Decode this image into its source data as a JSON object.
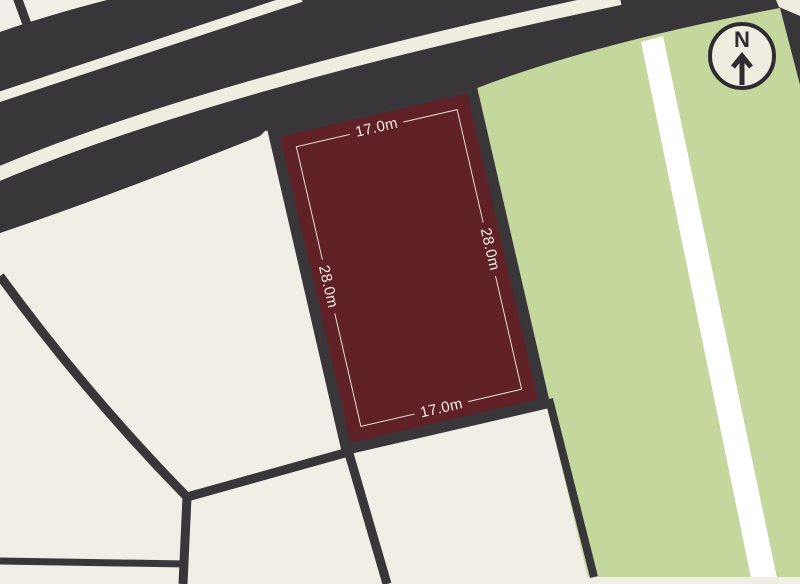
{
  "map": {
    "lot": {
      "dim_top": "17.0m",
      "dim_bottom": "17.0m",
      "dim_left": "28.0m",
      "dim_right": "28.0m"
    },
    "compass": {
      "label": "N",
      "icon": "north-arrow-icon"
    }
  },
  "colors": {
    "cream": "#f1eee6",
    "paper": "#efece0",
    "dark": "#383639",
    "red": "#5f2026",
    "green": "#c4d79c",
    "pure_white": "#ffffff",
    "dim_line": "#f2ede1",
    "label_text": "#f3efe5",
    "compass_ink": "#2e2c30"
  }
}
